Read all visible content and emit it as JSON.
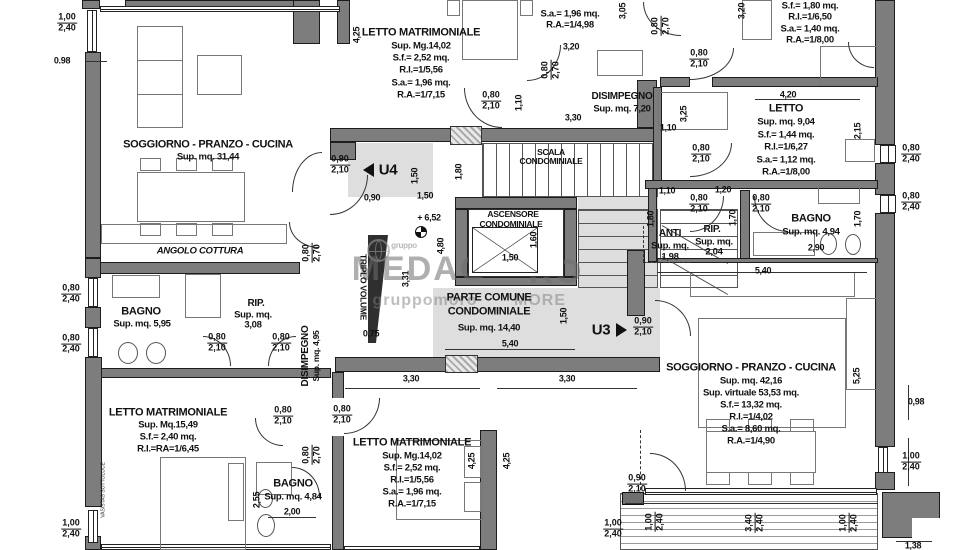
{
  "plan_type": "architectural floor plan",
  "units": [
    "U4",
    "U3"
  ],
  "labels": [
    {
      "n": "soggiorno-31-title",
      "t": "SOGGIORNO - PRANZO - CUCINA",
      "x": 208,
      "y": 145,
      "c": "title"
    },
    {
      "n": "soggiorno-31-area",
      "t": "Sup. mq. 31,44",
      "x": 208,
      "y": 157,
      "c": "sub"
    },
    {
      "n": "angolo-cottura-label",
      "t": "ANGOLO COTTURA",
      "x": 200,
      "y": 251,
      "c": "italic"
    },
    {
      "n": "bagno-595-title",
      "t": "BAGNO",
      "x": 141,
      "y": 312,
      "c": "title"
    },
    {
      "n": "bagno-595-area",
      "t": "Sup. mq. 5,95",
      "x": 142,
      "y": 324,
      "c": "sub"
    },
    {
      "n": "rip-308-title",
      "t": "RIP.",
      "x": 256,
      "y": 304,
      "c": "title2"
    },
    {
      "n": "rip-308-sub",
      "t": "Sup. mq.",
      "x": 253,
      "y": 315,
      "c": "sub"
    },
    {
      "n": "rip-308-area",
      "t": "3,08",
      "x": 253,
      "y": 325,
      "c": "sub"
    },
    {
      "n": "disimpegno-495-title",
      "t": "DISIMPEGNO",
      "x": 306,
      "y": 356,
      "r": -90,
      "c": "title2"
    },
    {
      "n": "disimpegno-495-area",
      "t": "Sup. mq. 4,95",
      "x": 316,
      "y": 356,
      "r": -90,
      "c": "small"
    },
    {
      "n": "letto-1549-title",
      "t": "LETTO MATRIMONIALE",
      "x": 168,
      "y": 413,
      "c": "title"
    },
    {
      "n": "letto-1549-l2",
      "t": "Sup. Mq.15,49",
      "x": 168,
      "y": 425,
      "c": "sub"
    },
    {
      "n": "letto-1549-l3",
      "t": "S.f.= 2,40 mq.",
      "x": 168,
      "y": 437,
      "c": "sub"
    },
    {
      "n": "letto-1549-l4",
      "t": "R.I.=RA=1/6,45",
      "x": 168,
      "y": 449,
      "c": "sub"
    },
    {
      "n": "bagno-484-title",
      "t": "BAGNO",
      "x": 293,
      "y": 484,
      "c": "title"
    },
    {
      "n": "bagno-484-area",
      "t": "Sup. mq. 4,84",
      "x": 293,
      "y": 497,
      "c": "sub"
    },
    {
      "n": "letto-top-title",
      "t": "LETTO MATRIMONIALE",
      "x": 421,
      "y": 33,
      "c": "title"
    },
    {
      "n": "letto-top-l2",
      "t": "Sup. Mg.14,02",
      "x": 421,
      "y": 46,
      "c": "sub"
    },
    {
      "n": "letto-top-l3",
      "t": "S.f.= 2,52 mq.",
      "x": 421,
      "y": 58,
      "c": "sub"
    },
    {
      "n": "letto-top-l4",
      "t": "R.I.=1/5,56",
      "x": 421,
      "y": 70,
      "c": "sub"
    },
    {
      "n": "letto-top-l5",
      "t": "S.a.= 1,96 mq.",
      "x": 421,
      "y": 83,
      "c": "sub"
    },
    {
      "n": "letto-top-l6",
      "t": "R.A.=1/7,15",
      "x": 421,
      "y": 95,
      "c": "sub"
    },
    {
      "n": "room-topcenter-l1",
      "t": "S.a.= 1,96 mq.",
      "x": 570,
      "y": 14,
      "c": "sub"
    },
    {
      "n": "room-topcenter-l2",
      "t": "R.A.=1/4,98",
      "x": 570,
      "y": 25,
      "c": "sub"
    },
    {
      "n": "disimpegno-720-title",
      "t": "DISIMPEGNO",
      "x": 622,
      "y": 97,
      "c": "title2"
    },
    {
      "n": "disimpegno-720-area",
      "t": "Sup. mq. 7,20",
      "x": 622,
      "y": 109,
      "c": "sub"
    },
    {
      "n": "room-topright-l1",
      "t": "S.f.= 1,80 mq.",
      "x": 810,
      "y": 6,
      "c": "sub"
    },
    {
      "n": "room-topright-l2",
      "t": "R.I.=1/6,50",
      "x": 810,
      "y": 17,
      "c": "sub"
    },
    {
      "n": "room-topright-l3",
      "t": "S.a.= 1,40 mq.",
      "x": 810,
      "y": 29,
      "c": "sub"
    },
    {
      "n": "room-topright-l4",
      "t": "R.A.=1/8,00",
      "x": 810,
      "y": 40,
      "c": "sub"
    },
    {
      "n": "letto-904-title",
      "t": "LETTO",
      "x": 786,
      "y": 109,
      "c": "title"
    },
    {
      "n": "letto-904-l2",
      "t": "Sup. mq. 9,04",
      "x": 786,
      "y": 122,
      "c": "sub"
    },
    {
      "n": "letto-904-l3",
      "t": "S.f.= 1,44 mq.",
      "x": 786,
      "y": 135,
      "c": "sub"
    },
    {
      "n": "letto-904-l4",
      "t": "R.I.=1/6,27",
      "x": 786,
      "y": 147,
      "c": "sub"
    },
    {
      "n": "letto-904-l5",
      "t": "S.a.= 1,12 mq.",
      "x": 786,
      "y": 160,
      "c": "sub"
    },
    {
      "n": "letto-904-l6",
      "t": "R.A.=1/8,00",
      "x": 786,
      "y": 172,
      "c": "sub"
    },
    {
      "n": "anti-title",
      "t": "ANTI",
      "x": 670,
      "y": 234,
      "c": "title2"
    },
    {
      "n": "anti-sub",
      "t": "Sup. mq.",
      "x": 670,
      "y": 246,
      "c": "sub"
    },
    {
      "n": "anti-area",
      "t": "1,98",
      "x": 670,
      "y": 257,
      "c": "sub"
    },
    {
      "n": "rip-204-title",
      "t": "RIP.",
      "x": 712,
      "y": 230,
      "c": "title2"
    },
    {
      "n": "rip-204-sub",
      "t": "Sup. mq.",
      "x": 714,
      "y": 242,
      "c": "sub"
    },
    {
      "n": "rip-204-area",
      "t": "2,04",
      "x": 714,
      "y": 252,
      "c": "sub"
    },
    {
      "n": "bagno-494-title",
      "t": "BAGNO",
      "x": 811,
      "y": 219,
      "c": "title"
    },
    {
      "n": "bagno-494-area",
      "t": "Sup. mq. 4,94",
      "x": 811,
      "y": 232,
      "c": "sub"
    },
    {
      "n": "soggiorno-42-title",
      "t": "SOGGIORNO - PRANZO - CUCINA",
      "x": 751,
      "y": 368,
      "c": "title"
    },
    {
      "n": "soggiorno-42-l2",
      "t": "Sup. mq. 42,16",
      "x": 751,
      "y": 381,
      "c": "sub"
    },
    {
      "n": "soggiorno-42-l3",
      "t": "Sup. virtuale 53,53 mq.",
      "x": 751,
      "y": 393,
      "c": "sub"
    },
    {
      "n": "soggiorno-42-l4",
      "t": "S.f.= 13,32 mq.",
      "x": 751,
      "y": 405,
      "c": "sub"
    },
    {
      "n": "soggiorno-42-l5",
      "t": "R.I.=1/4,02",
      "x": 751,
      "y": 417,
      "c": "sub"
    },
    {
      "n": "soggiorno-42-l6",
      "t": "S.a.= 8,60 mq.",
      "x": 751,
      "y": 429,
      "c": "sub"
    },
    {
      "n": "soggiorno-42-l7",
      "t": "R.A.=1/4,90",
      "x": 751,
      "y": 441,
      "c": "sub"
    },
    {
      "n": "letto-bottom-title",
      "t": "LETTO MATRIMONIALE",
      "x": 412,
      "y": 443,
      "c": "title"
    },
    {
      "n": "letto-bottom-l2",
      "t": "Sup. Mg.14,02",
      "x": 412,
      "y": 456,
      "c": "sub"
    },
    {
      "n": "letto-bottom-l3",
      "t": "S.f.= 2,52 mq.",
      "x": 412,
      "y": 468,
      "c": "sub"
    },
    {
      "n": "letto-bottom-l4",
      "t": "R.I.=1/5,56",
      "x": 412,
      "y": 480,
      "c": "sub"
    },
    {
      "n": "letto-bottom-l5",
      "t": "S.a.= 1,96 mq.",
      "x": 412,
      "y": 492,
      "c": "sub"
    },
    {
      "n": "letto-bottom-l6",
      "t": "R.A.=1/7,15",
      "x": 412,
      "y": 504,
      "c": "sub"
    },
    {
      "n": "scala-l1",
      "t": "SCALA",
      "x": 551,
      "y": 152,
      "c": "small"
    },
    {
      "n": "scala-l2",
      "t": "CONDOMINIALE",
      "x": 551,
      "y": 161,
      "c": "small"
    },
    {
      "n": "ascensore-l1",
      "t": "ASCENSORE",
      "x": 513,
      "y": 214,
      "c": "small"
    },
    {
      "n": "ascensore-l2",
      "t": "CONDOMINIALE",
      "x": 511,
      "y": 224,
      "c": "small"
    },
    {
      "n": "parte-comune-l1",
      "t": "PARTE COMUNE",
      "x": 489,
      "y": 298,
      "c": "title"
    },
    {
      "n": "parte-comune-l2",
      "t": "CONDOMINIALE",
      "x": 489,
      "y": 312,
      "c": "title"
    },
    {
      "n": "parte-comune-l3",
      "t": "Sup. mq. 14,40",
      "x": 489,
      "y": 328,
      "c": "sub"
    },
    {
      "n": "triplo-volume-label",
      "t": "TRIPLO VOLUME",
      "x": 363,
      "y": 287,
      "r": 90,
      "c": "small"
    },
    {
      "n": "unit-u4-label",
      "t": "U4",
      "x": 388,
      "y": 170,
      "c": "unit"
    },
    {
      "n": "unit-u3-label",
      "t": "U3",
      "x": 601,
      "y": 330,
      "c": "unit"
    },
    {
      "n": "vasistas-note",
      "t": "VASISTAS SOTTOLUCE",
      "x": 104,
      "y": 490,
      "r": -90,
      "c": "tiny"
    },
    {
      "n": "watermark-big-left",
      "t": "MEDAG",
      "x": 420,
      "y": 269,
      "c": "wmbig"
    },
    {
      "n": "watermark-big-right",
      "t": "RO",
      "x": 556,
      "y": 272,
      "c": "wmbig"
    },
    {
      "n": "watermark-small-left",
      "t": "gruppomoro",
      "x": 425,
      "y": 301,
      "c": "wmsmall"
    },
    {
      "n": "watermark-small-right",
      "t": "MORE",
      "x": 540,
      "y": 301,
      "c": "wmsmall"
    },
    {
      "n": "watermark-gruppo",
      "t": "gruppo",
      "x": 404,
      "y": 246,
      "c": "wmtiny"
    },
    {
      "n": "dim-098-left",
      "t": "0.98",
      "x": 62,
      "y": 61,
      "c": "d"
    },
    {
      "n": "dim-425-top",
      "t": "4,25",
      "x": 357,
      "y": 35,
      "r": -90,
      "c": "d"
    },
    {
      "n": "dim-305",
      "t": "3,05",
      "x": 623,
      "y": 11,
      "r": -90,
      "c": "d"
    },
    {
      "n": "dim-320-v",
      "t": "3,20",
      "x": 742,
      "y": 11,
      "r": -90,
      "c": "d"
    },
    {
      "n": "dim-320-h",
      "t": "3,20",
      "x": 571,
      "y": 47,
      "c": "d"
    },
    {
      "n": "dim-110-v1",
      "t": "1,10",
      "x": 519,
      "y": 103,
      "r": -90,
      "c": "d"
    },
    {
      "n": "dim-330-top",
      "t": "3,30",
      "x": 573,
      "y": 118,
      "c": "d"
    },
    {
      "n": "dim-110-h1",
      "t": "1,10",
      "x": 668,
      "y": 128,
      "c": "d"
    },
    {
      "n": "dim-325",
      "t": "3,25",
      "x": 684,
      "y": 114,
      "r": -90,
      "c": "d"
    },
    {
      "n": "dim-420",
      "t": "4,20",
      "x": 788,
      "y": 95,
      "c": "d"
    },
    {
      "n": "dim-215",
      "t": "2,15",
      "x": 858,
      "y": 131,
      "r": -90,
      "c": "d"
    },
    {
      "n": "dim-110-h2",
      "t": "1,10",
      "x": 667,
      "y": 191,
      "c": "d"
    },
    {
      "n": "dim-120",
      "t": "1,20",
      "x": 723,
      "y": 190,
      "c": "d"
    },
    {
      "n": "dim-180-anti",
      "t": "1,80",
      "x": 651,
      "y": 219,
      "r": -90,
      "c": "d"
    },
    {
      "n": "dim-170-a",
      "t": "1,70",
      "x": 733,
      "y": 218,
      "r": -90,
      "c": "d"
    },
    {
      "n": "dim-170-b",
      "t": "1,70",
      "x": 858,
      "y": 219,
      "r": -90,
      "c": "d"
    },
    {
      "n": "dim-290",
      "t": "2,90",
      "x": 816,
      "y": 248,
      "c": "d"
    },
    {
      "n": "dim-540-right",
      "t": "5,40",
      "x": 763,
      "y": 271,
      "c": "d"
    },
    {
      "n": "dim-525",
      "t": "5,25",
      "x": 857,
      "y": 376,
      "r": -90,
      "c": "d"
    },
    {
      "n": "dim-098-right",
      "t": "0,98",
      "x": 916,
      "y": 402,
      "c": "d"
    },
    {
      "n": "dim-138",
      "t": "1,38",
      "x": 913,
      "y": 546,
      "c": "d"
    },
    {
      "n": "dim-330-a",
      "t": "3,30",
      "x": 411,
      "y": 379,
      "c": "d"
    },
    {
      "n": "dim-330-b",
      "t": "3,30",
      "x": 567,
      "y": 379,
      "c": "d"
    },
    {
      "n": "dim-425-a",
      "t": "4,25",
      "x": 472,
      "y": 461,
      "r": -90,
      "c": "d"
    },
    {
      "n": "dim-425-b",
      "t": "4,25",
      "x": 507,
      "y": 461,
      "r": -90,
      "c": "d"
    },
    {
      "n": "dim-200",
      "t": "2,00",
      "x": 292,
      "y": 512,
      "c": "d"
    },
    {
      "n": "dim-255",
      "t": "2,55",
      "x": 257,
      "y": 500,
      "r": -90,
      "c": "d"
    },
    {
      "n": "dim-075",
      "t": "0,75",
      "x": 371,
      "y": 334,
      "c": "d"
    },
    {
      "n": "dim-331",
      "t": "3,31",
      "x": 406,
      "y": 279,
      "r": -90,
      "c": "d"
    },
    {
      "n": "dim-480",
      "t": "4,80",
      "x": 441,
      "y": 246,
      "r": -90,
      "c": "d"
    },
    {
      "n": "dim-150-u4v",
      "t": "1,50",
      "x": 415,
      "y": 176,
      "r": -90,
      "c": "d"
    },
    {
      "n": "dim-090-u4",
      "t": "0,90",
      "x": 372,
      "y": 198,
      "c": "d"
    },
    {
      "n": "dim-150-u4h",
      "t": "1,50",
      "x": 425,
      "y": 196,
      "c": "d"
    },
    {
      "n": "level-652",
      "t": "+ 6,52",
      "x": 429,
      "y": 218,
      "c": "d"
    },
    {
      "n": "dim-180-scala",
      "t": "1,80",
      "x": 459,
      "y": 172,
      "r": -90,
      "c": "d"
    },
    {
      "n": "dim-160-asc",
      "t": "1,60",
      "x": 534,
      "y": 240,
      "r": -90,
      "c": "d"
    },
    {
      "n": "dim-150-asc",
      "t": "1,50",
      "x": 510,
      "y": 258,
      "c": "d"
    },
    {
      "n": "dim-150-u3",
      "t": "1,50",
      "x": 564,
      "y": 316,
      "r": -90,
      "c": "d"
    },
    {
      "n": "dim-540-pc",
      "t": "5,40",
      "x": 510,
      "y": 344,
      "c": "d"
    }
  ],
  "fractions": [
    {
      "n": "win-100-240-topleft",
      "t": "1,00",
      "b": "2,40",
      "x": 67,
      "y": 23
    },
    {
      "n": "win-080-240-left1",
      "t": "0,80",
      "b": "2,40",
      "x": 71,
      "y": 294
    },
    {
      "n": "win-080-240-left2",
      "t": "0,80",
      "b": "2,40",
      "x": 71,
      "y": 344
    },
    {
      "n": "win-100-240-left3",
      "t": "1,00",
      "b": "2,40",
      "x": 71,
      "y": 529
    },
    {
      "n": "door-080-210-bagno595",
      "t": "0,80",
      "b": "2,10",
      "x": 217,
      "y": 343
    },
    {
      "n": "door-080-210-rip308",
      "t": "0,80",
      "b": "2,10",
      "x": 281,
      "y": 343
    },
    {
      "n": "door-080-210-dis495a",
      "t": "0,80",
      "b": "2,10",
      "x": 283,
      "y": 416
    },
    {
      "n": "door-080-270-bagno484",
      "t": "0,80",
      "b": "2,70",
      "x": 312,
      "y": 455,
      "r": -90
    },
    {
      "n": "door-080-210-lettob",
      "t": "0,80",
      "b": "2,10",
      "x": 342,
      "y": 415
    },
    {
      "n": "door-080-270-cottura",
      "t": "0,80",
      "b": "2,70",
      "x": 312,
      "y": 253,
      "r": -90
    },
    {
      "n": "door-080-210-lettotop",
      "t": "0,80",
      "b": "2,10",
      "x": 491,
      "y": 101
    },
    {
      "n": "door-080-270-distop",
      "t": "0,80",
      "b": "2,70",
      "x": 551,
      "y": 70,
      "r": -90
    },
    {
      "n": "door-080-270-topright",
      "t": "0,80",
      "b": "2,70",
      "x": 661,
      "y": 26,
      "r": -90
    },
    {
      "n": "door-080-210-tr1",
      "t": "0,80",
      "b": "2,10",
      "x": 699,
      "y": 59
    },
    {
      "n": "door-080-210-letto904",
      "t": "0,80",
      "b": "2,10",
      "x": 701,
      "y": 154
    },
    {
      "n": "win-080-240-right1",
      "t": "0,80",
      "b": "2,40",
      "x": 911,
      "y": 154
    },
    {
      "n": "win-080-240-right2",
      "t": "0,80",
      "b": "2,40",
      "x": 911,
      "y": 202
    },
    {
      "n": "door-080-210-rip204",
      "t": "0,80",
      "b": "2,10",
      "x": 699,
      "y": 204
    },
    {
      "n": "door-080-210-bagno494",
      "t": "0,80",
      "b": "2,10",
      "x": 761,
      "y": 204
    },
    {
      "n": "door-090-210-u3",
      "t": "0,90",
      "b": "2,10",
      "x": 643,
      "y": 327
    },
    {
      "n": "door-090-210-u4",
      "t": "0,90",
      "b": "2,10",
      "x": 340,
      "y": 165
    },
    {
      "n": "win-100-240-right3",
      "t": "1,00",
      "b": "2,40",
      "x": 911,
      "y": 462
    },
    {
      "n": "balc-100-240-a",
      "t": "1,00",
      "b": "2,40",
      "x": 655,
      "y": 522,
      "r": -90
    },
    {
      "n": "balc-340-240",
      "t": "3,40",
      "b": "2,40",
      "x": 755,
      "y": 523,
      "r": -90
    },
    {
      "n": "balc-100-240-b",
      "t": "1,00",
      "b": "2,40",
      "x": 849,
      "y": 523,
      "r": -90
    },
    {
      "n": "win-100-240-bottom",
      "t": "1,00",
      "b": "2,40",
      "x": 613,
      "y": 529
    },
    {
      "n": "door-090-210-balc",
      "t": "0,90",
      "b": "2,10",
      "x": 637,
      "y": 484
    }
  ]
}
